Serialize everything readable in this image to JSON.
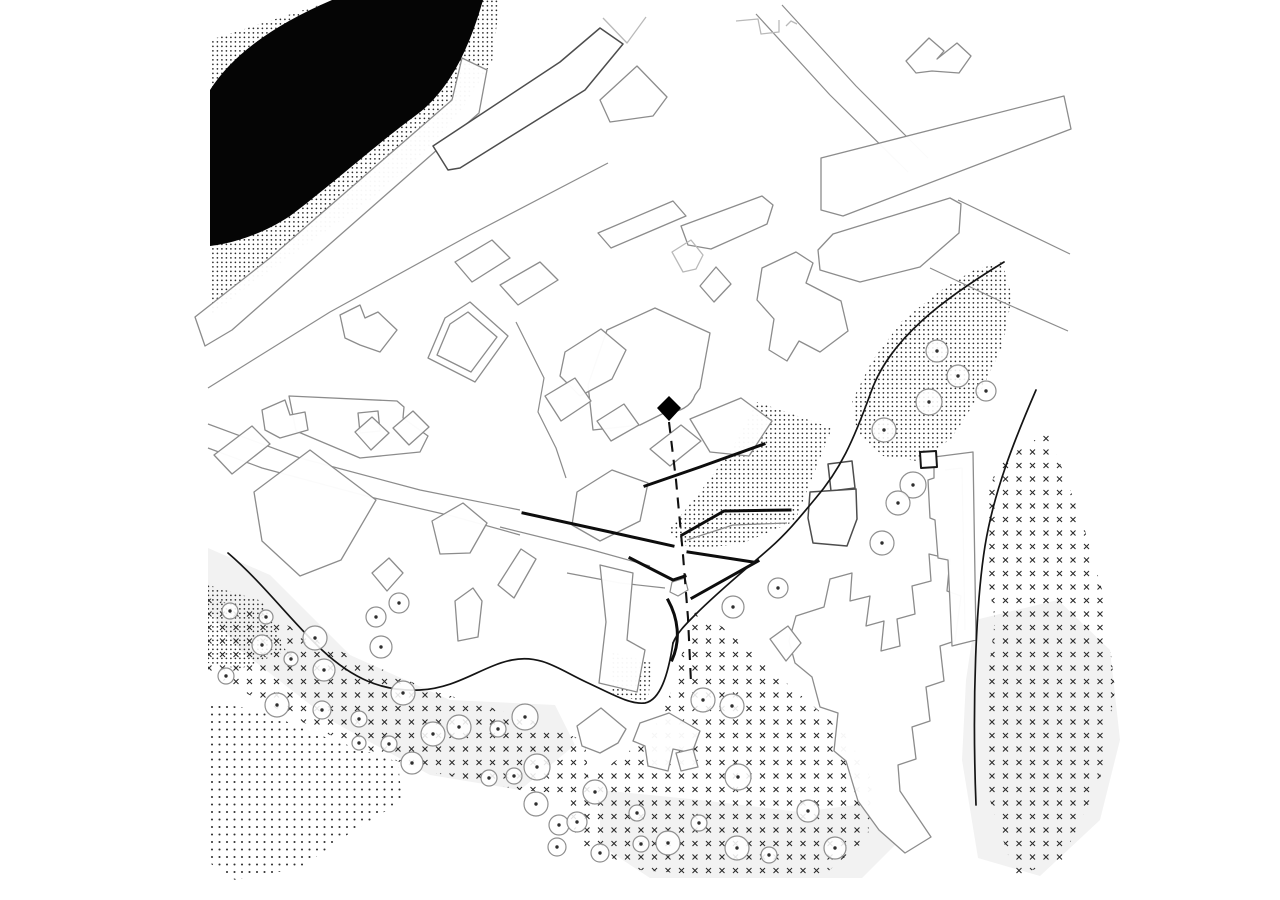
{
  "canvas": {
    "width": 1280,
    "height": 900,
    "background": "#ffffff"
  },
  "palette": {
    "building_line": "#8c8c8c",
    "building_line_dark": "#4d4d4d",
    "ink": "#0d0d0d",
    "water_fill": "#050505",
    "ground_tint": "#f2f2f2",
    "texture_mark": "#2b2b2b"
  },
  "site_marker": {
    "points": "669,396 681,408 669,421 657,408"
  },
  "sightline": {
    "d": "M669,422 L676,480 L683,555 L688,618 L691,683"
  },
  "layers": [
    {
      "name": "ground-tint-layer",
      "cls": "blob",
      "item": "ground-tint-patch",
      "features": [
        {
          "pts": "208,548 270,575 350,655 450,700 555,705 575,745 520,790 430,775 330,720 240,650 208,610"
        },
        {
          "pts": "600,790 700,800 800,812 880,802 900,840 862,878 650,878 600,845"
        },
        {
          "pts": "975,620 1058,600 1110,650 1120,740 1100,820 1040,876 978,858 962,760 966,680"
        }
      ]
    },
    {
      "name": "stipple-layer",
      "cls": "pat-dots",
      "item": "stipple-field",
      "features": [
        {
          "pts": "210,40 335,0 500,0 492,62 460,112 424,154 370,200 306,245 250,285 210,316"
        },
        {
          "pts": "1002,262 1012,297 1002,347 977,399 951,439 917,461 883,456 857,432 852,401 872,361 902,321 940,291 972,271"
        },
        {
          "pts": "757,402 832,428 795,521 741,544 690,549 668,531 700,492 731,450"
        },
        {
          "pts": "612,652 652,663 648,703 610,693"
        },
        {
          "pts": "208,585 262,601 286,651 240,669 208,663"
        }
      ]
    },
    {
      "name": "dot-grid-layer",
      "cls": "pat-dots2",
      "item": "dot-grid-field",
      "features": [
        {
          "pts": "208,702 258,710 330,739 398,762 402,801 350,833 300,868 235,880 208,862"
        }
      ]
    },
    {
      "name": "cross-hatch-layer",
      "cls": "pat-x",
      "item": "cross-field",
      "features": [
        {
          "pts": "208,598 260,612 340,651 430,690 520,716 585,741 590,796 520,790 420,770 320,731 240,690 208,672"
        },
        {
          "pts": "695,612 726,629 790,686 845,733 872,780 868,838 820,878 740,878 640,870 580,845 565,805 600,772 650,736 672,690 683,650"
        },
        {
          "pts": "998,462 1048,432 1082,520 1105,600 1115,690 1100,780 1062,860 1015,876 990,800 985,700 995,620 982,545 988,495"
        }
      ]
    },
    {
      "name": "water-layer",
      "cls": "water",
      "item": "water-body",
      "features": [
        {
          "d": "M210,90 Q243,38 332,0 L483,0 C470,46 450,91 415,116 C378,143 330,186 290,216 C260,236 228,244 210,246 Z"
        }
      ]
    },
    {
      "name": "street-layer",
      "cls": "line",
      "item": "street-edge",
      "features": [
        {
          "pts": "208,388 330,312 470,235 608,163",
          "open": true
        },
        {
          "pts": "208,424 300,458 420,490 520,510",
          "open": true
        },
        {
          "pts": "208,448 262,468 370,497 452,516 520,535",
          "open": true
        },
        {
          "pts": "756,14 830,95 908,172",
          "open": true
        },
        {
          "pts": "782,5 856,86 928,158",
          "open": true
        },
        {
          "pts": "958,200 1070,254",
          "open": true
        },
        {
          "pts": "930,268 1000,301 1068,331",
          "open": true
        },
        {
          "pts": "516,322 544,378 538,412 556,448 566,478",
          "open": true
        },
        {
          "pts": "500,527 585,548 650,566",
          "open": true
        },
        {
          "pts": "687,540 733,525 787,523",
          "open": true
        },
        {
          "pts": "567,573 620,583 665,588",
          "open": true
        },
        {
          "pts": "672,582 685,578 688,590 678,596 670,592"
        },
        {
          "pts": "945,470 962,468 965,630",
          "open": true
        }
      ]
    },
    {
      "name": "building-layer",
      "cls": "bld",
      "item": "building",
      "features": [
        {
          "pts": "462,58 487,70 479,113 232,330 205,346 195,317 270,258 452,100"
        },
        {
          "pts": "340,315 360,305 365,318 378,312 397,330 380,352 360,345 345,338"
        },
        {
          "pts": "428,358 445,318 470,302 508,336 475,382"
        },
        {
          "pts": "437,355 450,324 468,312 497,337 471,372"
        },
        {
          "pts": "289,396 397,401 404,407 403,418 428,436 420,452 360,458 296,431"
        },
        {
          "pts": "358,413 378,411 380,431 360,433"
        },
        {
          "pts": "262,410 285,400 290,415 305,412 308,430 280,438 265,430"
        },
        {
          "pts": "254,492 310,450 376,500 341,560 300,576 262,541"
        },
        {
          "pts": "214,455 252,426 270,444 232,474"
        },
        {
          "pts": "355,432 372,417 389,433 371,450"
        },
        {
          "pts": "393,428 413,411 429,427 409,445"
        },
        {
          "pts": "455,262 492,240 510,258 472,282"
        },
        {
          "pts": "500,285 540,262 558,280 518,305"
        },
        {
          "pts": "600,100 637,66 667,97 653,116 610,122"
        },
        {
          "pts": "681,226 762,196 773,205 767,224 711,249 688,245"
        },
        {
          "pts": "598,233 673,201 686,216 611,248"
        },
        {
          "pts": "906,61 929,38 944,51 937,59 957,43 971,56 959,73 932,71 916,73"
        },
        {
          "pts": "821,158 1064,96 1071,129 843,216 821,210"
        },
        {
          "pts": "833,234 950,198 961,204 959,233 920,267 860,282 820,270 818,250"
        },
        {
          "d": "M607,330 L655,308 L710,333 L700,388 L695,395 C691,407 678,413 668,411 L640,425 L593,430 L588,385 Z"
        },
        {
          "pts": "700,286 716,267 731,284 714,302"
        },
        {
          "pts": "762,268 796,252 813,263 806,283 841,301 848,331 820,352 799,341 787,361 769,350 774,319 757,300"
        },
        {
          "pts": "565,352 601,329 626,350 612,379 580,396 560,376"
        },
        {
          "pts": "545,396 575,378 591,401 561,421"
        },
        {
          "pts": "597,421 624,404 639,425 611,441"
        },
        {
          "pts": "650,449 681,425 701,441 670,466"
        },
        {
          "pts": "690,419 741,398 772,421 749,456 710,452"
        },
        {
          "pts": "577,492 612,470 648,483 640,521 600,541 572,525"
        },
        {
          "pts": "600,565 633,573 627,640 645,650 637,692 599,683 606,622"
        },
        {
          "pts": "498,585 521,549 536,559 514,598"
        },
        {
          "pts": "455,601 473,588 482,601 478,637 458,641"
        },
        {
          "pts": "432,521 463,503 487,523 470,553 440,554"
        },
        {
          "pts": "372,573 389,558 403,573 387,591"
        },
        {
          "pts": "577,726 601,708 626,729 618,743 600,753 582,746"
        },
        {
          "pts": "640,723 669,713 700,731 692,753 673,749 668,771 648,766 645,746 633,741"
        },
        {
          "pts": "676,753 693,749 698,767 681,771"
        },
        {
          "pts": "796,616 824,607 830,579 852,573 850,601 870,596 866,626 884,621 881,651 900,646 897,619 915,614 912,586 931,581 929,554 950,559 947,591 961,596 955,641 940,646 944,681 926,687 930,721 912,727 916,759 898,765 900,791 931,837 905,853 879,830 858,801 846,761 834,751 838,713 820,707 812,677 795,663 789,641"
        },
        {
          "pts": "770,639 788,626 801,643 786,661"
        },
        {
          "pts": "934,457 973,452 976,640 952,646 948,560 938,558 935,520 930,518 928,480 934,478"
        }
      ]
    },
    {
      "name": "building-dark-layer",
      "cls": "bld-dark",
      "item": "building-dark",
      "features": [
        {
          "pts": "433,146 560,62 600,28 623,44 585,90 460,168 448,170"
        },
        {
          "pts": "828,464 852,461 855,488 831,491"
        },
        {
          "pts": "810,492 856,489 857,519 847,546 813,543 808,518"
        },
        {
          "pts": "920,452 936,451 937,467 921,468",
          "cls": "bld-darker"
        }
      ]
    },
    {
      "name": "building-light-layer",
      "cls": "bld-light",
      "item": "building-faint",
      "features": [
        {
          "pts": "603,18 627,43 646,17",
          "open": true
        },
        {
          "pts": "736,21 758,19 761,34 779,32 779,20",
          "open": true
        },
        {
          "pts": "786,26 791,21 797,24",
          "open": true
        },
        {
          "pts": "672,252 691,240 703,255 696,269 683,272"
        }
      ]
    },
    {
      "name": "retaining-wall-layer",
      "cls": "wall",
      "item": "retaining-wall",
      "features": [
        {
          "pts": "645,486 700,467 764,444",
          "open": true
        },
        {
          "pts": "523,513 610,532 673,546",
          "open": true
        },
        {
          "pts": "682,535 724,511 790,510",
          "open": true
        },
        {
          "pts": "688,552 753,562",
          "open": true
        },
        {
          "pts": "630,558 673,580 685,576",
          "open": true
        },
        {
          "pts": "692,598 758,561",
          "open": true
        },
        {
          "d": "M668,600 C678,618 681,640 672,660"
        }
      ]
    },
    {
      "name": "road-layer",
      "cls": "road",
      "item": "road-line",
      "features": [
        {
          "d": "M1004,262 C945,298 890,338 871,392 C853,442 840,470 815,499 C800,517 788,532 770,548 C745,570 720,590 695,615 C685,625 677,633 673,643"
        },
        {
          "d": "M1036,390 C1014,441 994,491 985,546 C976,602 972,702 976,805"
        },
        {
          "d": "M228,553 C262,582 292,622 322,650 C352,678 382,692 420,690 C458,688 482,666 512,660 C541,654 560,670 586,682 C610,693 630,705 645,703 C660,700 668,676 673,643"
        }
      ]
    },
    {
      "name": "tree-layer",
      "kind": "trees",
      "item": "tree",
      "features": [
        [
          230,
          611,
          8
        ],
        [
          266,
          617,
          7
        ],
        [
          262,
          645,
          10
        ],
        [
          291,
          659,
          7
        ],
        [
          315,
          638,
          12
        ],
        [
          324,
          670,
          11
        ],
        [
          226,
          676,
          8
        ],
        [
          376,
          617,
          10
        ],
        [
          399,
          603,
          10
        ],
        [
          381,
          647,
          11
        ],
        [
          403,
          693,
          12
        ],
        [
          277,
          705,
          12
        ],
        [
          322,
          710,
          9
        ],
        [
          359,
          719,
          8
        ],
        [
          359,
          743,
          7
        ],
        [
          389,
          744,
          8
        ],
        [
          412,
          763,
          11
        ],
        [
          433,
          734,
          12
        ],
        [
          459,
          727,
          12
        ],
        [
          498,
          729,
          8
        ],
        [
          525,
          717,
          13
        ],
        [
          489,
          778,
          8
        ],
        [
          514,
          776,
          8
        ],
        [
          537,
          767,
          13
        ],
        [
          536,
          804,
          12
        ],
        [
          559,
          825,
          10
        ],
        [
          557,
          847,
          9
        ],
        [
          595,
          792,
          12
        ],
        [
          577,
          822,
          10
        ],
        [
          600,
          853,
          9
        ],
        [
          637,
          813,
          8
        ],
        [
          641,
          844,
          8
        ],
        [
          668,
          843,
          12
        ],
        [
          699,
          823,
          8
        ],
        [
          737,
          848,
          12
        ],
        [
          769,
          855,
          8
        ],
        [
          808,
          811,
          11
        ],
        [
          835,
          848,
          11
        ],
        [
          738,
          777,
          13
        ],
        [
          703,
          700,
          12
        ],
        [
          732,
          706,
          12
        ],
        [
          733,
          607,
          11
        ],
        [
          778,
          588,
          10
        ],
        [
          913,
          485,
          13
        ],
        [
          898,
          503,
          12
        ],
        [
          882,
          543,
          12
        ],
        [
          884,
          430,
          12
        ],
        [
          929,
          402,
          13
        ],
        [
          937,
          351,
          11
        ],
        [
          958,
          376,
          11
        ],
        [
          986,
          391,
          10
        ]
      ]
    }
  ]
}
